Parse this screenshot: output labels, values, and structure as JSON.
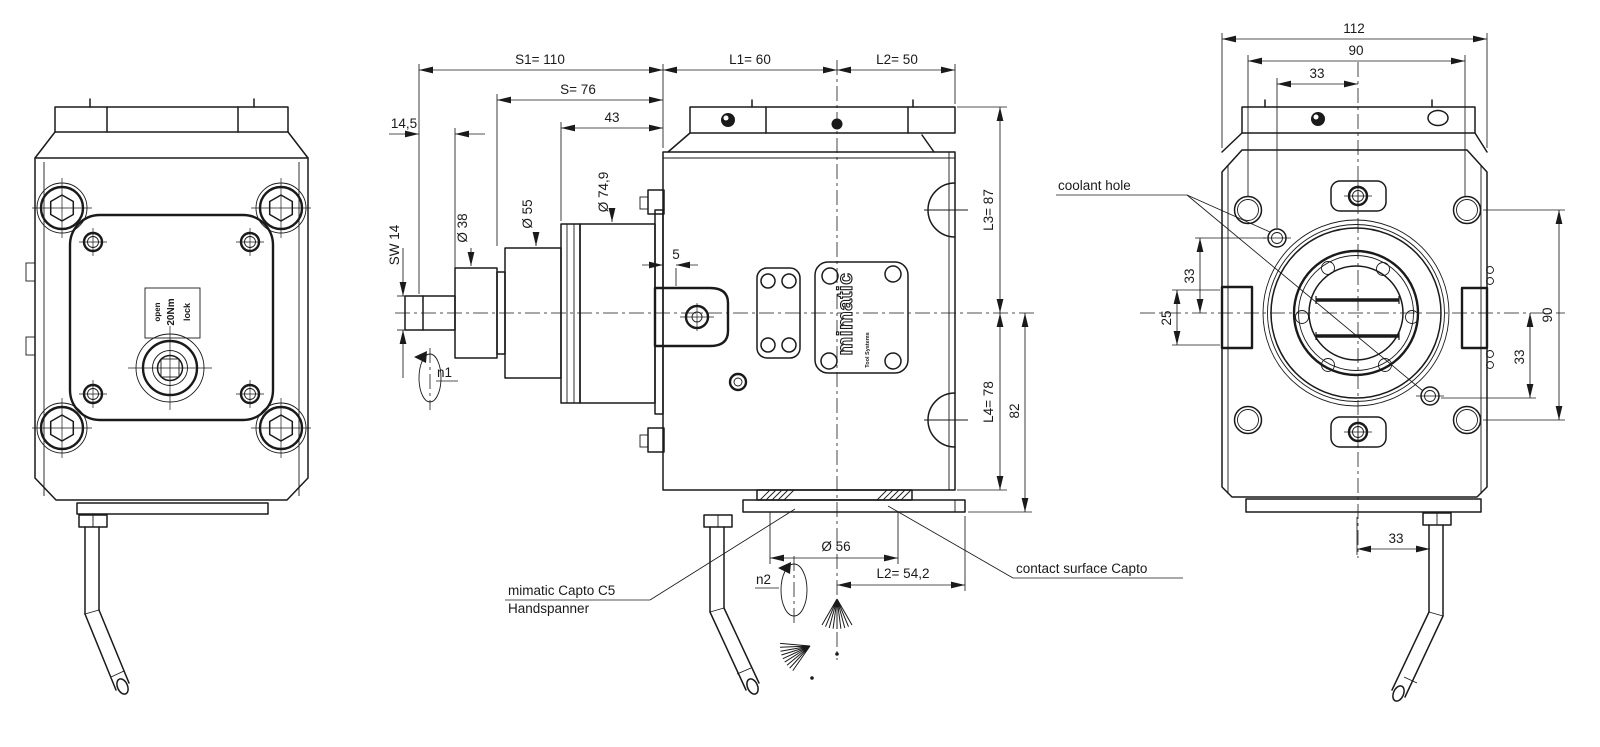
{
  "drawing": {
    "background": "#ffffff",
    "line_color": "#1a1a1a"
  },
  "left_view": {
    "plate_label": {
      "line1": "open",
      "line2": "20Nm",
      "line3": "lock"
    }
  },
  "side_view": {
    "dims": {
      "s1": "S1= 110",
      "s": "S= 76",
      "d43": "43",
      "d14_5": "14,5",
      "sw14": "SW 14",
      "d38": "Ø 38",
      "d55": "Ø 55",
      "d74_9": "Ø 74,9",
      "d5": "5",
      "l1": "L1= 60",
      "l2": "L2= 50",
      "l3": "L3= 87",
      "l4": "L4= 78",
      "d82": "82",
      "d56": "Ø 56",
      "l2_capto": "L2= 54,2"
    },
    "speeds": {
      "n1": "n1",
      "n2": "n2"
    },
    "logo": {
      "brand": "mimatic",
      "sub": "Tool Systems"
    },
    "labels": {
      "clamp_line1": "mimatic Capto C5",
      "clamp_line2": "Handspanner",
      "contact": "contact surface Capto"
    }
  },
  "rear_view": {
    "dims": {
      "width_112": "112",
      "holes_h_90": "90",
      "top_33": "33",
      "coolant_33": "33",
      "block_25": "25",
      "holes_v_90": "90",
      "right_33": "33",
      "handle_33": "33"
    },
    "labels": {
      "coolant": "coolant hole"
    }
  }
}
